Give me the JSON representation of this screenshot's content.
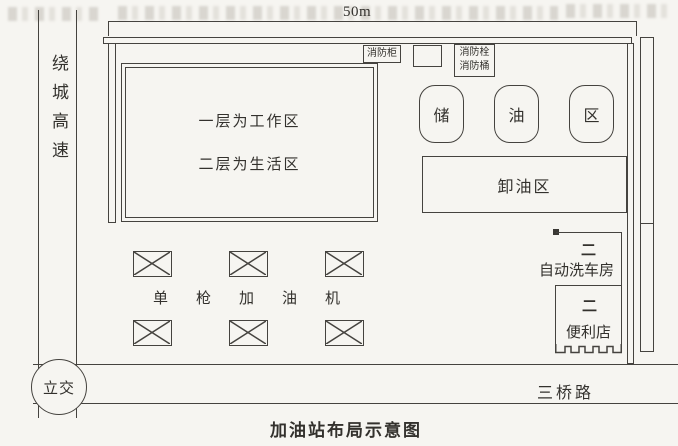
{
  "title": "加油站布局示意图",
  "dimension_label": "50m",
  "roads": {
    "left_road_label": "绕城高速",
    "bottom_road_label": "三桥路",
    "interchange_label": "立交"
  },
  "building": {
    "line1": "一层为工作区",
    "line2": "二层为生活区"
  },
  "fire_equipment": {
    "cabinet_label": "消防柜",
    "hydrant_label": "消防栓",
    "bucket_label": "消防桶"
  },
  "tank_labels": [
    "储",
    "油",
    "区"
  ],
  "unloading_label": "卸油区",
  "dispensers": {
    "label": "单枪加油机",
    "count": 6
  },
  "car_wash": {
    "door_symbol": "二",
    "label": "自动洗车房"
  },
  "store": {
    "door_symbol": "二",
    "label": "便利店"
  },
  "colors": {
    "paper": "#f6f5f1",
    "line": "#45433f",
    "text": "#33312d"
  }
}
